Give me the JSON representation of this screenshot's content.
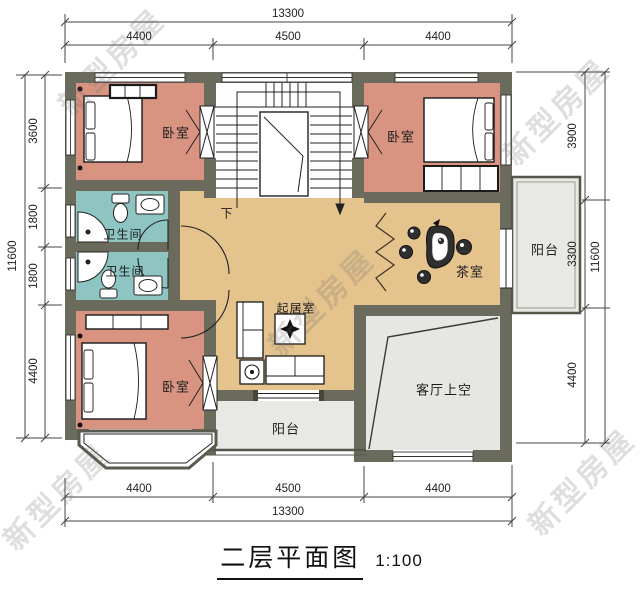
{
  "title": {
    "name": "二层平面图",
    "scale": "1:100"
  },
  "watermark": {
    "text": "新型房屋"
  },
  "rooms": {
    "bedroom_tl": {
      "label": "卧室"
    },
    "bedroom_tr": {
      "label": "卧室"
    },
    "bedroom_bl": {
      "label": "卧室"
    },
    "bathroom_upper": {
      "label": "卫生间"
    },
    "bathroom_lower": {
      "label": "卫生间"
    },
    "tea_room": {
      "label": "茶室"
    },
    "living_room": {
      "label": "起居室"
    },
    "balcony_right": {
      "label": "阳台"
    },
    "balcony_bottom": {
      "label": "阳台"
    },
    "void_over_living": {
      "label": "客厅上空"
    },
    "stair_down": {
      "label": "下"
    }
  },
  "dimensions": {
    "top": {
      "total": "13300",
      "segments": [
        "4400",
        "4500",
        "4400"
      ]
    },
    "bottom": {
      "total": "13300",
      "segments": [
        "4400",
        "4500",
        "4400"
      ]
    },
    "left": {
      "total": "11600",
      "segments": [
        "3600",
        "1800",
        "1800",
        "4400"
      ]
    },
    "right": {
      "total": "11600",
      "segments": [
        "3900",
        "3300",
        "4400"
      ]
    }
  },
  "colors": {
    "wall": "#6b6b5d",
    "bedroom": "#d89381",
    "bathroom": "#8ec5c2",
    "hall": "#e4c38d",
    "balcony": "#e8e8e4",
    "voidarea": "#e6e6e2",
    "line": "#222222"
  }
}
